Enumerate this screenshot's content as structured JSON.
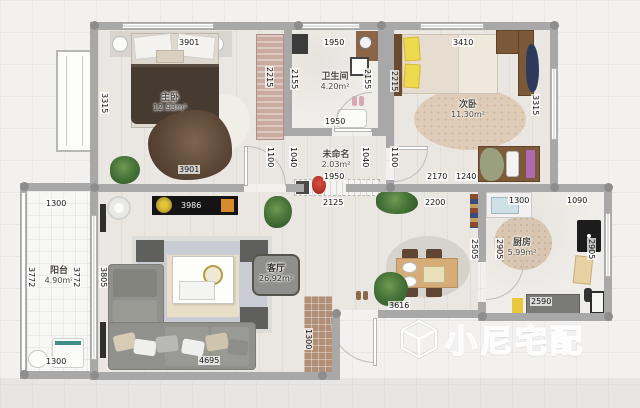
{
  "watermark": {
    "text": "小尼宅配"
  },
  "rooms": {
    "master": {
      "name": "主卧",
      "area": "12.93m²"
    },
    "bath": {
      "name": "卫生间",
      "area": "4.20m²"
    },
    "bed2": {
      "name": "次卧",
      "area": "11.30m²"
    },
    "hall": {
      "name": "未命名",
      "area": "2.03m²"
    },
    "living": {
      "name": "客厅",
      "area": "26.92m²"
    },
    "kitchen": {
      "name": "厨房",
      "area": "5.99m²"
    },
    "balcony": {
      "name": "阳台",
      "area": "4.90m²"
    }
  },
  "dims": {
    "master_top": "3901",
    "bath_top": "1950",
    "bed2_top": "3410",
    "master_left": "3315",
    "master_ward": "2215",
    "bath_left": "2155",
    "bath_right": "2155",
    "bed2_left": "2215",
    "bed2_right": "3315",
    "master_bottom": "3901",
    "bath_bottom": "1950",
    "hall_l2": "1100",
    "hall_l1": "1040",
    "hall_width": "1950",
    "hall_r1": "1040",
    "hall_r2": "1100",
    "hall_right": "2170",
    "desk": "1240",
    "pass_left": "2125",
    "pass_right": "2200",
    "tv": "3986",
    "living_left": "3805",
    "sofa": "4695",
    "entry": "1300",
    "dining_bottom": "3616",
    "dining_right": "2505",
    "kitchen_left": "2905",
    "kitchen_right": "2905",
    "kitchen_top_l": "1300",
    "kitchen_top_r": "1090",
    "kitchen_bottom": "2590",
    "balcony_top": "1300",
    "balcony_bottom": "1300",
    "balcony_left": "3772",
    "balcony_right": "3772"
  },
  "palette": {
    "wall": "#a8a8a8",
    "floorwood": "#eae7e2",
    "sofa": "#90908c",
    "woodbrown": "#7a5838"
  }
}
